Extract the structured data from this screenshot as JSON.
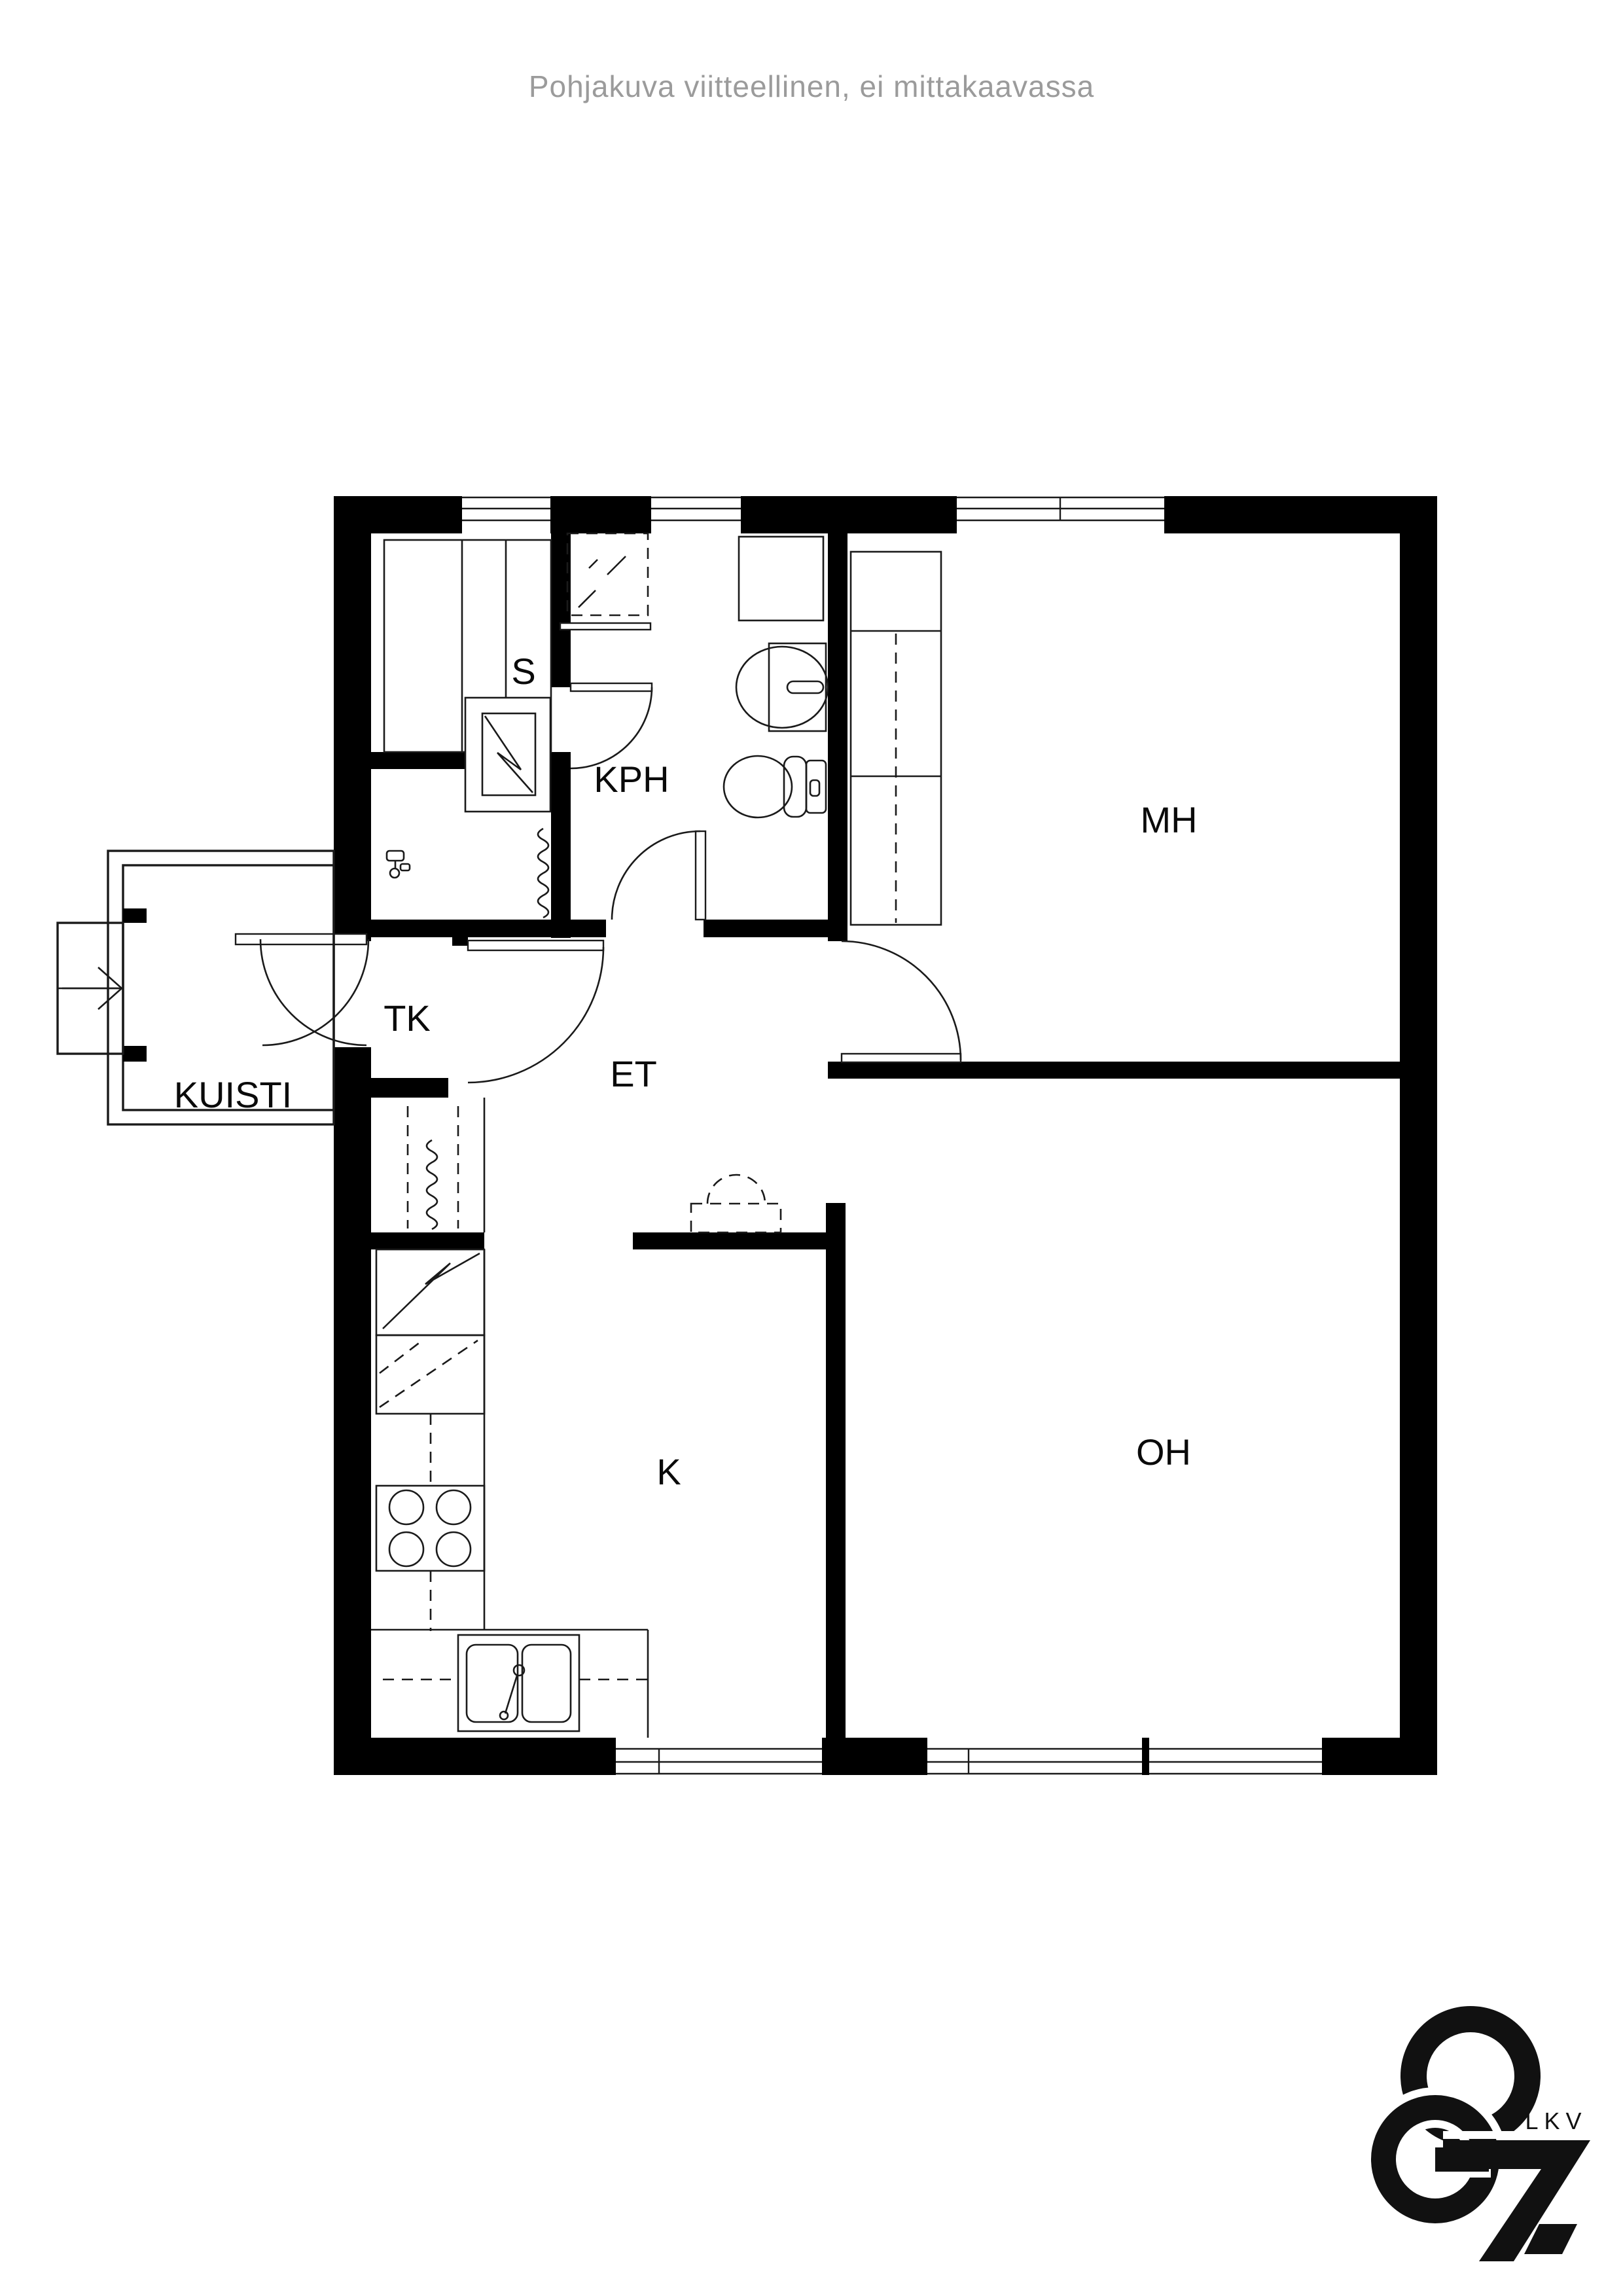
{
  "page": {
    "background": "#ffffff"
  },
  "header": {
    "disclaimer": "Pohjakuva viitteellinen, ei mittakaavassa",
    "color": "#9b9b9b"
  },
  "floorplan": {
    "type": "apartment-floor-plan",
    "rooms": [
      {
        "id": "sauna",
        "label": "S"
      },
      {
        "id": "bathroom",
        "label": "KPH"
      },
      {
        "id": "bedroom",
        "label": "MH"
      },
      {
        "id": "vestibule",
        "label": "TK"
      },
      {
        "id": "porch",
        "label": "KUISTI"
      },
      {
        "id": "hallway",
        "label": "ET"
      },
      {
        "id": "kitchen",
        "label": "K"
      },
      {
        "id": "living-room",
        "label": "OH"
      }
    ],
    "colors": {
      "wall": "#000000",
      "line": "#1a1a1a"
    }
  },
  "logo": {
    "text": "LKV",
    "color": "#111111"
  }
}
